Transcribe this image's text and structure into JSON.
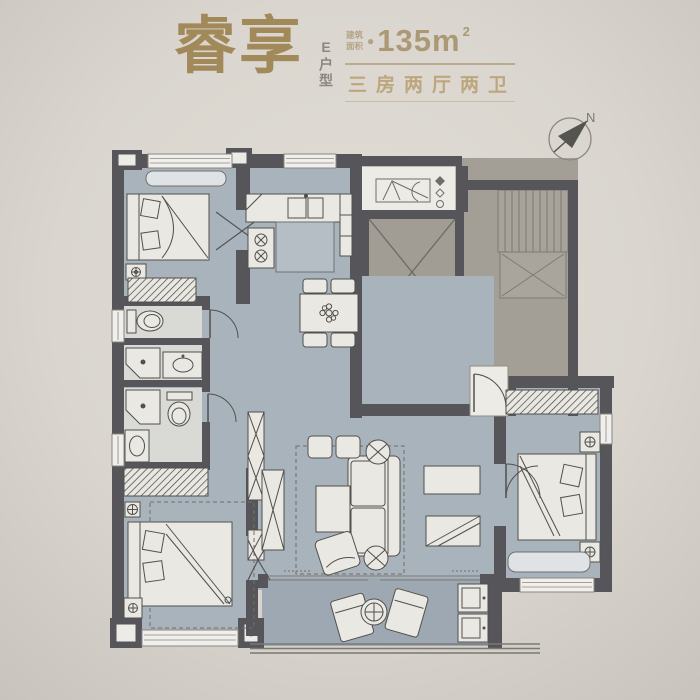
{
  "page": {
    "background": "#dcd8d1"
  },
  "header": {
    "title": "睿享",
    "unit_type": "E户型",
    "area_label_line1": "建筑",
    "area_label_line2": "面积",
    "area_bullet": "●",
    "area_value": "135m",
    "area_superscript": "2",
    "layout_summary": "三房两厅两卫",
    "title_color": "#a1895a",
    "gold_color": "#b9ac90"
  },
  "compass": {
    "label": "N"
  },
  "floorplan": {
    "wall_color": "#56565a",
    "unit_floor_color": "#a9b3bc",
    "balcony_floor_color": "#9da8b2",
    "common_floor_color": "#a49f96",
    "bathroom_floor_color": "#d9dad6",
    "fixture_color": "#eceae5"
  }
}
